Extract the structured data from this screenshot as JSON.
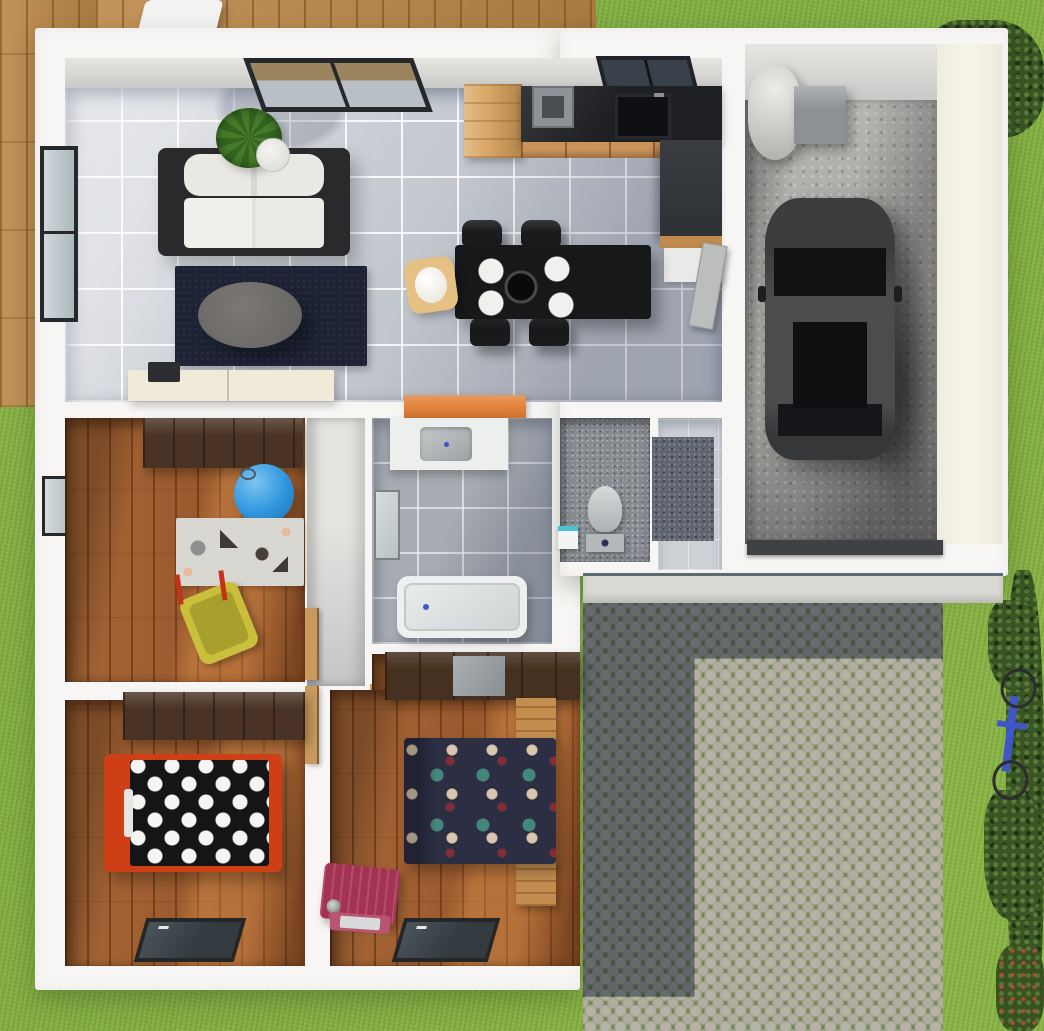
{
  "meta": {
    "scene": "3d-top-down-house-floor-plan-render",
    "canvas_width": 1044,
    "canvas_height": 1031
  },
  "palette": {
    "grass": "#8cb548",
    "deck_wood": "#b5854a",
    "wall_white": "#f7f6f4",
    "tile_floor": "#c2c6cd",
    "bath_tile": "#a7acb2",
    "wood_floor": "#9a5c31",
    "concrete": "#a8a7a3",
    "cobblestone": "#b6b3a6",
    "moss_joint": "#6f8c49",
    "rug_navy": "#1d2335",
    "accent_orange": "#e2823a",
    "bed_frame_red": "#cf3f16",
    "ball_blue": "#2f95de",
    "toy_yellow": "#c9bf3c",
    "suitcase_magenta": "#a33253",
    "car_body": "#2e2f31",
    "bike_blue": "#4056c6"
  },
  "rooms": [
    "living-room",
    "kitchen-dining",
    "nursery",
    "bathroom",
    "wc",
    "entry-hall",
    "corridor",
    "bedroom-single",
    "bedroom-double",
    "garage",
    "driveway",
    "deck",
    "garden"
  ],
  "elements": [
    {
      "name": "garden-grass",
      "cls": "grass",
      "x": 0,
      "y": 0,
      "w": 1044,
      "h": 1031
    },
    {
      "name": "wood-deck-left",
      "cls": "deck",
      "x": 0,
      "y": 0,
      "w": 100,
      "h": 407
    },
    {
      "name": "wood-deck-top",
      "cls": "deck",
      "x": 96,
      "y": 0,
      "w": 500,
      "h": 33
    },
    {
      "name": "patio-chair",
      "cls": "patio-chair",
      "x": 140,
      "y": 0,
      "w": 78,
      "h": 46
    },
    {
      "name": "hedge-top-right",
      "cls": "bush",
      "x": 925,
      "y": 20,
      "w": 119,
      "h": 118
    },
    {
      "name": "bush-right-column",
      "cls": "bush",
      "x": 1006,
      "y": 570,
      "w": 38,
      "h": 461
    },
    {
      "name": "bush-blob-upper",
      "cls": "bush",
      "x": 988,
      "y": 600,
      "w": 52,
      "h": 90
    },
    {
      "name": "bush-blob-lower",
      "cls": "bush",
      "x": 984,
      "y": 790,
      "w": 58,
      "h": 130
    },
    {
      "name": "flower-bed-corner",
      "cls": "bush-flowers",
      "x": 996,
      "y": 945,
      "w": 48,
      "h": 86
    },
    {
      "name": "bicycle",
      "cls": "bike",
      "x": 990,
      "y": 668,
      "w": 44,
      "h": 132,
      "t": "rotate(7deg)"
    },
    {
      "name": "house-main-block",
      "cls": "wall-white",
      "x": 35,
      "y": 28,
      "w": 545,
      "h": 962
    },
    {
      "name": "house-garage-wing",
      "cls": "wall-white",
      "x": 560,
      "y": 28,
      "w": 448,
      "h": 548
    },
    {
      "name": "front-walkway",
      "cls": "walkway",
      "x": 583,
      "y": 573,
      "w": 420,
      "h": 30
    },
    {
      "name": "driveway-cobblestone",
      "cls": "cobbles",
      "x": 583,
      "y": 603,
      "w": 360,
      "h": 428
    },
    {
      "name": "driveway-house-shadow",
      "cls": "drive-shadow",
      "x": 583,
      "y": 603,
      "w": 360,
      "h": 428
    },
    {
      "name": "garage-wall-top",
      "cls": "wallface",
      "x": 745,
      "y": 44,
      "w": 192,
      "h": 58
    },
    {
      "name": "garage-wall-right",
      "cls": "wallface-warm",
      "x": 937,
      "y": 44,
      "w": 66,
      "h": 500
    },
    {
      "name": "garage-floor",
      "cls": "concrete",
      "x": 745,
      "y": 100,
      "w": 192,
      "h": 444
    },
    {
      "name": "garage-shadow",
      "cls": "garage-shade",
      "x": 745,
      "y": 100,
      "w": 192,
      "h": 444
    },
    {
      "name": "water-heater",
      "cls": "heater",
      "x": 748,
      "y": 64,
      "w": 54,
      "h": 96
    },
    {
      "name": "utility-box",
      "cls": "gray-box",
      "x": 794,
      "y": 86,
      "w": 52,
      "h": 58
    },
    {
      "name": "car-shadow",
      "cls": "soft-shadow",
      "x": 880,
      "y": 240,
      "w": 58,
      "h": 290
    },
    {
      "name": "car",
      "cls": "car",
      "x": 765,
      "y": 198,
      "w": 130,
      "h": 262
    },
    {
      "name": "garage-door-threshold",
      "cls": "dark-bar",
      "x": 747,
      "y": 540,
      "w": 196,
      "h": 15
    },
    {
      "name": "living-wall-top",
      "cls": "wallface",
      "x": 65,
      "y": 58,
      "w": 657,
      "h": 32
    },
    {
      "name": "living-kitchen-floor",
      "cls": "tile-light",
      "x": 65,
      "y": 88,
      "w": 657,
      "h": 314
    },
    {
      "name": "living-kitchen-shadow",
      "cls": "diag-shade",
      "x": 65,
      "y": 88,
      "w": 657,
      "h": 314
    },
    {
      "name": "living-window-top",
      "cls": "window-top",
      "x": 253,
      "y": 58,
      "w": 170,
      "h": 54,
      "t": "skewX(20deg)"
    },
    {
      "name": "kitchen-window",
      "cls": "window-top2",
      "x": 601,
      "y": 56,
      "w": 94,
      "h": 42,
      "t": "skewX(14deg)"
    },
    {
      "name": "living-window-left",
      "cls": "window-left",
      "x": 40,
      "y": 146,
      "w": 38,
      "h": 176
    },
    {
      "name": "nursery-window-left",
      "cls": "window-left-sm",
      "x": 42,
      "y": 476,
      "w": 32,
      "h": 60
    },
    {
      "name": "sofa",
      "cls": "sofa",
      "x": 158,
      "y": 148,
      "w": 192,
      "h": 108
    },
    {
      "name": "potted-plant",
      "cls": "plant",
      "x": 216,
      "y": 108,
      "w": 66,
      "h": 60
    },
    {
      "name": "living-rug",
      "cls": "rug-navy",
      "x": 175,
      "y": 266,
      "w": 192,
      "h": 100
    },
    {
      "name": "coffee-table",
      "cls": "coffee-table",
      "x": 198,
      "y": 282,
      "w": 104,
      "h": 66
    },
    {
      "name": "tv-sideboard",
      "cls": "sideboard",
      "x": 128,
      "y": 370,
      "w": 206,
      "h": 31
    },
    {
      "name": "sideboard-item",
      "cls": "dark-box-sm",
      "x": 148,
      "y": 362,
      "w": 32,
      "h": 20
    },
    {
      "name": "kitchen-wood-cabinet",
      "cls": "wood-cab",
      "x": 464,
      "y": 84,
      "w": 58,
      "h": 74
    },
    {
      "name": "kitchen-counter",
      "cls": "counter-dark",
      "x": 521,
      "y": 86,
      "w": 201,
      "h": 57
    },
    {
      "name": "range-hood",
      "cls": "hood-gray",
      "x": 532,
      "y": 86,
      "w": 42,
      "h": 42
    },
    {
      "name": "kitchen-sink",
      "cls": "sink-dark",
      "x": 615,
      "y": 94,
      "w": 56,
      "h": 45
    },
    {
      "name": "kitchen-drawers",
      "cls": "drawers-wood",
      "x": 521,
      "y": 142,
      "w": 182,
      "h": 16
    },
    {
      "name": "tall-cabinet",
      "cls": "cab-dark",
      "x": 660,
      "y": 140,
      "w": 62,
      "h": 98
    },
    {
      "name": "cabinet-wood-edge",
      "cls": "wood-strip",
      "x": 660,
      "y": 236,
      "w": 62,
      "h": 12
    },
    {
      "name": "low-cabinet",
      "cls": "cab-white",
      "x": 664,
      "y": 248,
      "w": 58,
      "h": 34
    },
    {
      "name": "garage-door-leaf",
      "cls": "door-leaf",
      "x": 703,
      "y": 242,
      "w": 25,
      "h": 85,
      "t": "rotate(10deg)"
    },
    {
      "name": "dining-chair-1",
      "cls": "chair-black",
      "x": 462,
      "y": 220,
      "w": 40,
      "h": 27
    },
    {
      "name": "dining-chair-2",
      "cls": "chair-black",
      "x": 521,
      "y": 220,
      "w": 40,
      "h": 27
    },
    {
      "name": "dining-chair-3",
      "cls": "chair-black",
      "x": 470,
      "y": 317,
      "w": 40,
      "h": 29
    },
    {
      "name": "dining-chair-4",
      "cls": "chair-black",
      "x": 529,
      "y": 317,
      "w": 40,
      "h": 29
    },
    {
      "name": "dining-table",
      "cls": "table-black",
      "x": 455,
      "y": 245,
      "w": 196,
      "h": 74
    },
    {
      "name": "baby-high-chair",
      "cls": "high-chair",
      "x": 406,
      "y": 258,
      "w": 50,
      "h": 54,
      "t": "rotate(-8deg)"
    },
    {
      "name": "orange-doormat",
      "cls": "mat-orange",
      "x": 404,
      "y": 395,
      "w": 122,
      "h": 25
    },
    {
      "name": "nursery-floor",
      "cls": "wood-floor",
      "x": 65,
      "y": 418,
      "w": 240,
      "h": 264
    },
    {
      "name": "nursery-wardrobe",
      "cls": "wardrobe-dark",
      "x": 143,
      "y": 418,
      "w": 160,
      "h": 50
    },
    {
      "name": "play-ball",
      "cls": "ball-blue",
      "x": 234,
      "y": 464,
      "w": 60,
      "h": 60
    },
    {
      "name": "animal-print-rug",
      "cls": "rug-animal",
      "x": 176,
      "y": 518,
      "w": 128,
      "h": 68
    },
    {
      "name": "toy-wheelbarrow",
      "cls": "toy-barrow",
      "x": 188,
      "y": 588,
      "w": 62,
      "h": 70,
      "t": "rotate(-22deg)"
    },
    {
      "name": "corridor-floor",
      "cls": "corridor",
      "x": 307,
      "y": 418,
      "w": 58,
      "h": 268
    },
    {
      "name": "door-nursery",
      "cls": "door-wood",
      "x": 305,
      "y": 608,
      "w": 14,
      "h": 72
    },
    {
      "name": "door-bedroom-single",
      "cls": "door-wood",
      "x": 305,
      "y": 686,
      "w": 14,
      "h": 78
    },
    {
      "name": "door-bedroom-double",
      "cls": "door-wood",
      "x": 370,
      "y": 684,
      "w": 14,
      "h": 80
    },
    {
      "name": "bathroom-floor",
      "cls": "tile-bath",
      "x": 372,
      "y": 418,
      "w": 180,
      "h": 226
    },
    {
      "name": "bathroom-shadow",
      "cls": "diag-shade2",
      "x": 372,
      "y": 418,
      "w": 180,
      "h": 226
    },
    {
      "name": "vanity-sink",
      "cls": "vanity",
      "x": 390,
      "y": 418,
      "w": 118,
      "h": 52
    },
    {
      "name": "bathroom-mirror",
      "cls": "mirror",
      "x": 374,
      "y": 490,
      "w": 26,
      "h": 70
    },
    {
      "name": "bathtub",
      "cls": "bathtub",
      "x": 397,
      "y": 576,
      "w": 130,
      "h": 62
    },
    {
      "name": "wc-floor",
      "cls": "floor-speckle",
      "x": 560,
      "y": 418,
      "w": 90,
      "h": 144
    },
    {
      "name": "toilet",
      "cls": "toilet",
      "x": 584,
      "y": 486,
      "w": 44,
      "h": 66
    },
    {
      "name": "wc-bin",
      "cls": "wc-box",
      "x": 558,
      "y": 526,
      "w": 20,
      "h": 23
    },
    {
      "name": "entry-floor",
      "cls": "tile-entry",
      "x": 658,
      "y": 418,
      "w": 64,
      "h": 152
    },
    {
      "name": "entry-mat",
      "cls": "speckle-mat",
      "x": 652,
      "y": 437,
      "w": 62,
      "h": 104
    },
    {
      "name": "bedroom-single-floor",
      "cls": "wood-floor",
      "x": 65,
      "y": 700,
      "w": 240,
      "h": 266
    },
    {
      "name": "bedroom-single-wardrobe",
      "cls": "wardrobe-dark",
      "x": 123,
      "y": 692,
      "w": 182,
      "h": 48
    },
    {
      "name": "single-bed",
      "cls": "bed1",
      "x": 104,
      "y": 754,
      "w": 178,
      "h": 118
    },
    {
      "name": "bedroom-single-window",
      "cls": "window-bottom",
      "x": 140,
      "y": 918,
      "w": 100,
      "h": 44,
      "t": "skewX(-16deg)"
    },
    {
      "name": "bedroom-double-floor-upper",
      "cls": "wood-floor",
      "x": 372,
      "y": 654,
      "w": 208,
      "h": 44
    },
    {
      "name": "bedroom-double-floor",
      "cls": "wood-floor",
      "x": 330,
      "y": 690,
      "w": 250,
      "h": 276
    },
    {
      "name": "bedroom-double-wardrobe",
      "cls": "wardrobe-dark2",
      "x": 385,
      "y": 652,
      "w": 195,
      "h": 48
    },
    {
      "name": "nightstand-top",
      "cls": "wood-cab-sm",
      "x": 516,
      "y": 698,
      "w": 40,
      "h": 46
    },
    {
      "name": "nightstand-bottom",
      "cls": "wood-cab-sm",
      "x": 516,
      "y": 860,
      "w": 40,
      "h": 46
    },
    {
      "name": "double-bed",
      "cls": "bed2",
      "x": 404,
      "y": 738,
      "w": 152,
      "h": 126
    },
    {
      "name": "suitcase",
      "cls": "suitcase",
      "x": 322,
      "y": 866,
      "w": 76,
      "h": 56,
      "t": "rotate(6deg)"
    },
    {
      "name": "suitcase-lid",
      "cls": "suitcase-lid",
      "x": 330,
      "y": 914,
      "w": 60,
      "h": 18,
      "t": "rotate(4deg)"
    },
    {
      "name": "bedroom-double-window",
      "cls": "window-bottom",
      "x": 398,
      "y": 918,
      "w": 96,
      "h": 44,
      "t": "skewX(-16deg)"
    }
  ]
}
